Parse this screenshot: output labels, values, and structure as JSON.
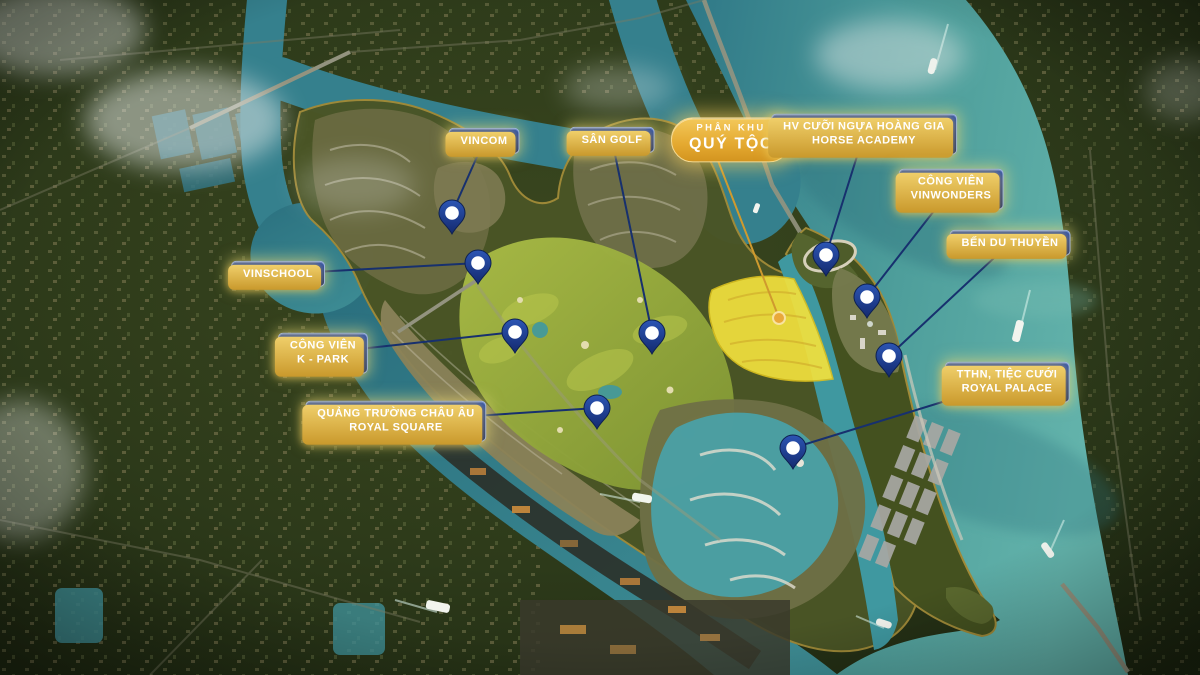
{
  "map": {
    "description": "Aerial masterplan render with project callouts",
    "colors": {
      "label_blue_top": "#3156b0",
      "label_blue_bottom": "#12296b",
      "label_border": "#9db6e6",
      "label_gold_edge": "#e0aa3e",
      "label_text": "#ffffff",
      "gold_badge_top": "#f3c85a",
      "gold_badge_bottom": "#d3941f",
      "leader_line": "#17306e",
      "gold_leader_line": "#cf9a2e",
      "pin_fill": "#1d3f97",
      "pin_dot": "#ffffff",
      "highlight_zone": "#f2e13d",
      "water": "#3f8f96",
      "water_right": "#55a7a1",
      "land": "#2f3a1d",
      "golf": "#93a53c"
    },
    "highlight_zone": {
      "label_ref": "phan-khu-quy-toc",
      "color": "#f2e13d"
    }
  },
  "callouts": [
    {
      "id": "vincom",
      "style": "standard",
      "lines": [
        "VINCOM"
      ],
      "cx": 484,
      "cy": 141,
      "pin": {
        "x": 452,
        "y": 213
      }
    },
    {
      "id": "san-golf",
      "style": "standard",
      "lines": [
        "SÂN GOLF"
      ],
      "cx": 612,
      "cy": 140,
      "pin": {
        "x": 652,
        "y": 333
      }
    },
    {
      "id": "phan-khu-quy-toc",
      "style": "gold",
      "lines": [
        "PHÂN KHU",
        "QUÝ TỘC"
      ],
      "cx": 731,
      "cy": 140,
      "target": {
        "x": 779,
        "y": 318
      }
    },
    {
      "id": "horse-academy",
      "style": "standard",
      "lines": [
        "HV CƯỠI NGỰA HOÀNG GIA",
        "HORSE ACADEMY"
      ],
      "cx": 864,
      "cy": 134,
      "pin": {
        "x": 826,
        "y": 255
      }
    },
    {
      "id": "cong-vien-vinwonders",
      "style": "standard",
      "lines": [
        "CÔNG VIÊN",
        "VINWONDERS"
      ],
      "cx": 951,
      "cy": 189,
      "pin": {
        "x": 867,
        "y": 297
      }
    },
    {
      "id": "ben-du-thuyen",
      "style": "standard",
      "lines": [
        "BẾN DU THUYỀN"
      ],
      "cx": 1010,
      "cy": 243,
      "pin": {
        "x": 889,
        "y": 356
      }
    },
    {
      "id": "vinschool",
      "style": "standard",
      "lines": [
        "VINSCHOOL"
      ],
      "cx": 278,
      "cy": 274,
      "pin": {
        "x": 478,
        "y": 263
      }
    },
    {
      "id": "cong-vien-k-park",
      "style": "standard",
      "lines": [
        "CÔNG VIÊN",
        "K - PARK"
      ],
      "cx": 323,
      "cy": 353,
      "pin": {
        "x": 515,
        "y": 332
      }
    },
    {
      "id": "royal-square",
      "style": "standard",
      "lines": [
        "QUẢNG TRƯỜNG CHÂU ÂU",
        "ROYAL SQUARE"
      ],
      "cx": 396,
      "cy": 421,
      "pin": {
        "x": 597,
        "y": 408
      }
    },
    {
      "id": "royal-palace",
      "style": "standard",
      "lines": [
        "TTHN, TIỆC CƯỚI",
        "ROYAL PALACE"
      ],
      "cx": 1007,
      "cy": 382,
      "pin": {
        "x": 793,
        "y": 448
      }
    }
  ]
}
